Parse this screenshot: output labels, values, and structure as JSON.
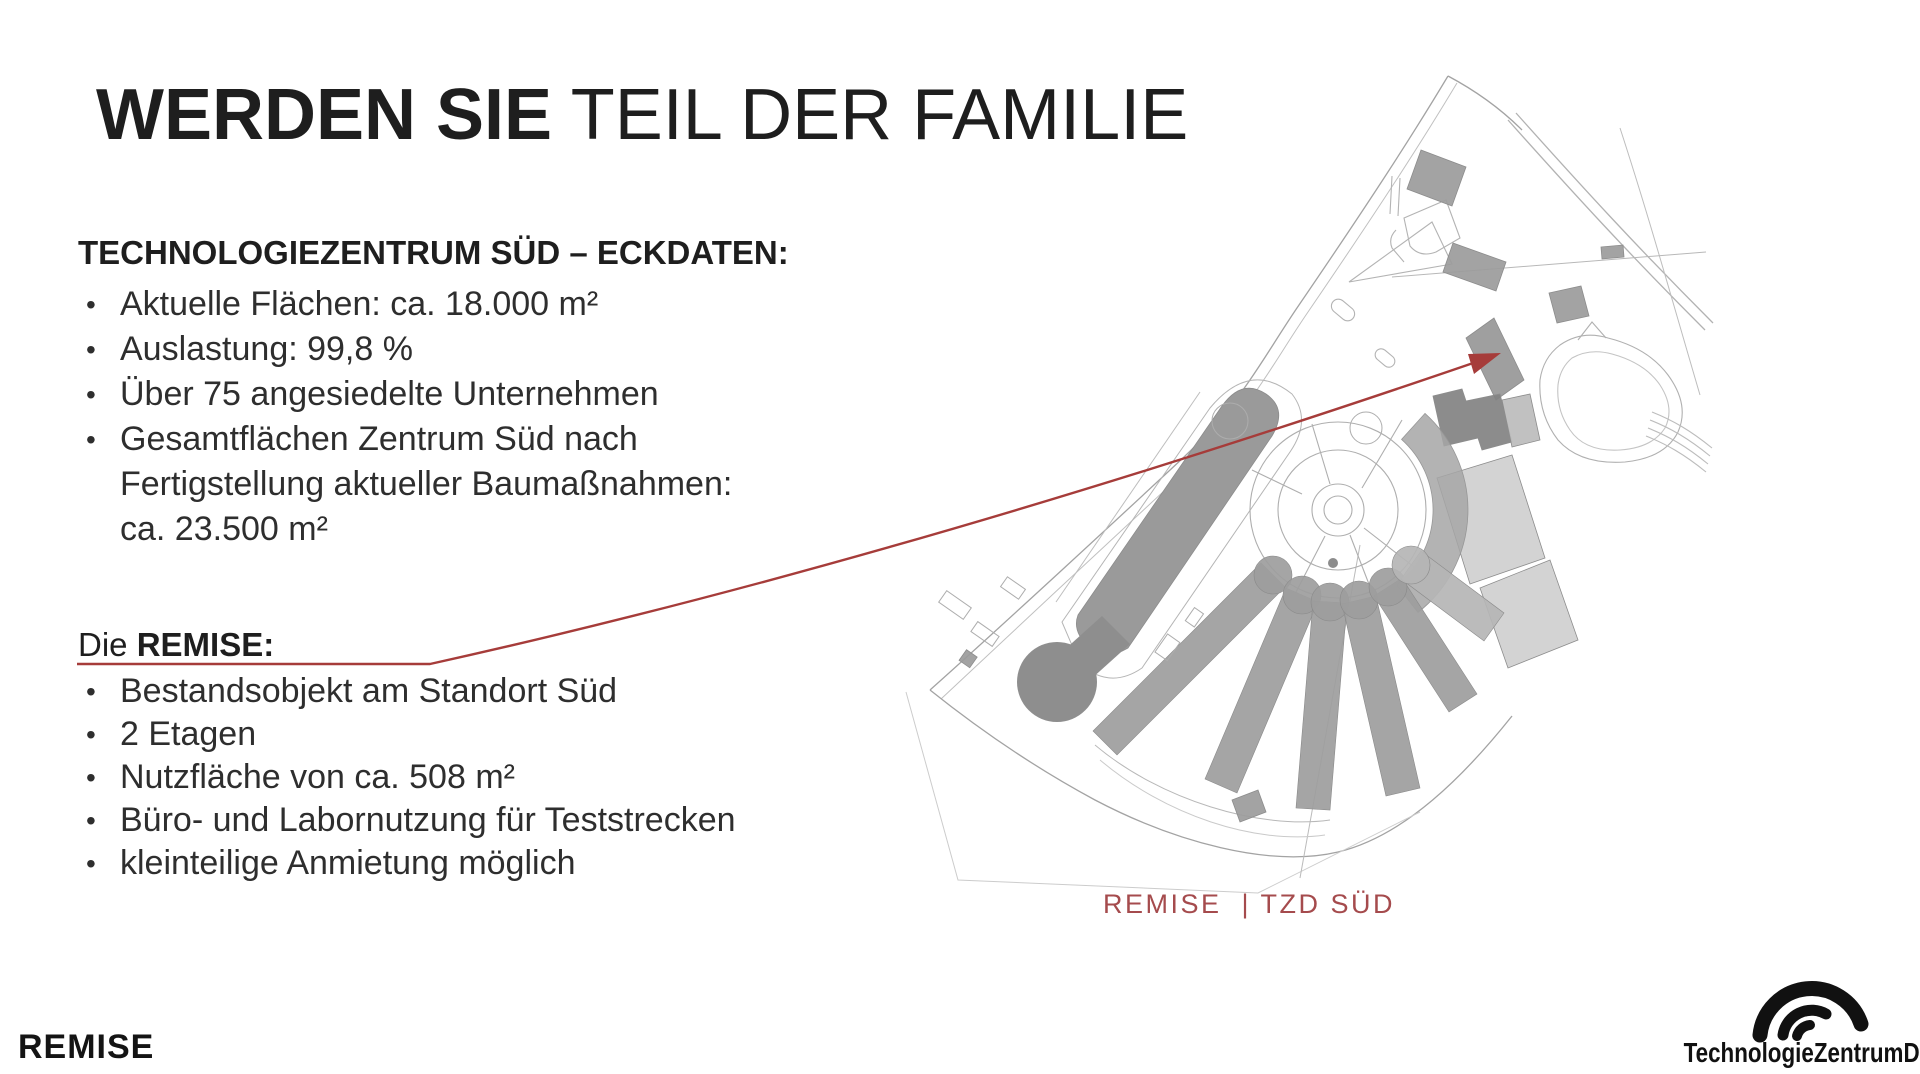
{
  "slide": {
    "title": {
      "emphasis": "WERDEN SIE",
      "rest": " TEIL DER FAMILIE"
    },
    "eckdaten": {
      "heading": "TECHNOLOGIEZENTRUM SÜD – ECKDATEN:",
      "bullets": [
        "Aktuelle Flächen: ca. 18.000 m²",
        "Auslastung: 99,8 %",
        "Über 75 angesiedelte Unternehmen",
        "Gesamtflächen Zentrum Süd nach\nFertigstellung aktueller Baumaßnahmen:\nca. 23.500 m²"
      ]
    },
    "remise": {
      "lead": "Die ",
      "heading": "REMISE:",
      "bullets": [
        "Bestandsobjekt am Standort Süd",
        "2 Etagen",
        "Nutzfläche von ca. 508 m²",
        "Büro- und Labornutzung für Teststrecken",
        "kleinteilige Anmietung möglich"
      ]
    },
    "map_caption": "REMISE  | TZD SÜD",
    "footer_brand": "REMISE",
    "logo_text": "TechnologieZentrumDresden"
  },
  "glyphs": {
    "bullet": "•"
  },
  "colors": {
    "accent_red": "#a63c3a",
    "caption_red": "#a54b4d",
    "text_dark": "#1e1e1e",
    "map_building_gray": "#9b9b9b",
    "map_building_dark": "#828282",
    "map_building_light": "#c8c8c8",
    "map_line_gray": "#a8a8a8"
  }
}
